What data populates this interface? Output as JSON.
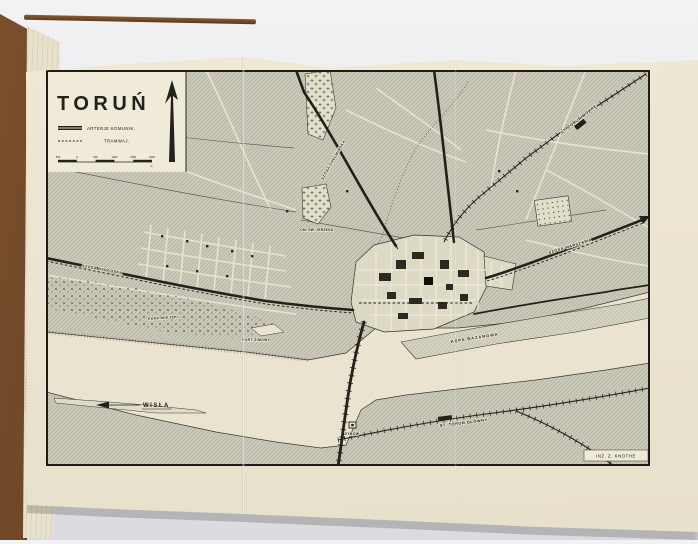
{
  "map": {
    "title": "TORUŃ",
    "credit": "INŻ. Z. KNOTHE",
    "legend": {
      "artery_label": "ARTERJE KOMUNIK.",
      "tram_label": "TRAMWAJ.",
      "scale_ticks": [
        "500",
        "0",
        "500",
        "1000",
        "1500",
        "2000"
      ],
      "scale_unit": "m."
    },
    "labels": {
      "river": "WISŁA",
      "park": "PARK MIEJSKI",
      "winter_port": "PORT ZIMOWY",
      "island": "KĘPA BAZAROWA",
      "castle_ruin": "DYBÓW",
      "cemetery": "CM. ŚW. JERZEGO",
      "station_northeast": "ST. TORUŃ MOKRE",
      "station_south": "ST. TORUŃ GŁÓWNY",
      "road_east": "SZOSA WARSZAWA",
      "road_west": "SZOSA BYDGOSKA",
      "road_north": "SZOSA CHEŁMIŃSKA"
    },
    "colors": {
      "ink": "#23211c",
      "paper": "#ece5d1",
      "land_hatch": "#c9c8b8",
      "book_cover": "#5b3a20"
    }
  }
}
